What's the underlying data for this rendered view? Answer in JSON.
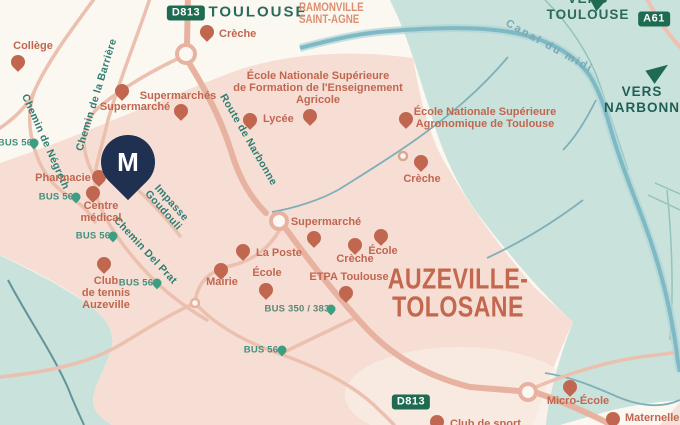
{
  "marker": {
    "letter": "M"
  },
  "badges": {
    "d813_top": "D813",
    "a61": "A61",
    "d813_bottom": "D813"
  },
  "cities": {
    "toulouse": "TOULOUSE",
    "ramonville": {
      "l1": "RAMONVILLE",
      "l2": "SAINT-AGNE"
    },
    "auzeville": {
      "l1": "AUZEVILLE-",
      "l2": "TOLOSANE"
    }
  },
  "directions": {
    "vers_toulouse": {
      "l1": "VERS",
      "l2": "TOULOUSE"
    },
    "vers_narbonne": {
      "l1": "VERS",
      "l2": "NARBONNE"
    }
  },
  "streets": {
    "barriere": "Chemin de la Barrière",
    "negreth": "Chemin de Négreth",
    "narbonne": "Route de Narbonne",
    "goudouli": {
      "l1": "Impasse",
      "l2": "Goudouli"
    },
    "delprat": "Chemin Del Prat",
    "canal": "Canal du midi"
  },
  "pois": [
    {
      "lines": [
        "Collège"
      ]
    },
    {
      "lines": [
        "Crèche"
      ]
    },
    {
      "lines": [
        "Supermarchés"
      ]
    },
    {
      "lines": [
        "Supermarché"
      ]
    },
    {
      "lines": [
        "Pharmacie"
      ]
    },
    {
      "lines": [
        "Centre",
        "médical"
      ]
    },
    {
      "lines": [
        "Club",
        "de tennis",
        "Auzeville"
      ]
    },
    {
      "lines": [
        "École Nationale Supérieure",
        "de Formation de l'Enseignement",
        "Agricole"
      ]
    },
    {
      "lines": [
        "Lycée"
      ]
    },
    {
      "lines": [
        "École Nationale Supérieure",
        "Agronomique de Toulouse"
      ]
    },
    {
      "lines": [
        "Crèche"
      ]
    },
    {
      "lines": [
        "Supermarché"
      ]
    },
    {
      "lines": [
        "La Poste"
      ]
    },
    {
      "lines": [
        "Mairie"
      ]
    },
    {
      "lines": [
        "École"
      ]
    },
    {
      "lines": [
        "Crèche"
      ]
    },
    {
      "lines": [
        "École"
      ]
    },
    {
      "lines": [
        "ETPA Toulouse"
      ]
    },
    {
      "lines": [
        "Micro-École"
      ]
    },
    {
      "lines": [
        "Maternelle"
      ]
    },
    {
      "lines": [
        "Club de sport"
      ]
    }
  ],
  "bus_stops": [
    {
      "label": "BUS 56"
    },
    {
      "label": "BUS 56"
    },
    {
      "label": "BUS 56"
    },
    {
      "label": "BUS 56"
    },
    {
      "label": "BUS 56"
    },
    {
      "label": "BUS 350 / 383"
    }
  ],
  "colors": {
    "background_cream": "#FBF7F1",
    "urban_pink": "#F6DED4",
    "field_teal": "#C9E2DB",
    "road_salmon": "#E7B2A0",
    "canal_blue": "#7FB9C4",
    "poi_terracotta": "#C1664F",
    "street_teal": "#2F7D72",
    "bus_green": "#3D9E82",
    "badge_green": "#1E6B52",
    "city_dark_teal": "#2A6A5B",
    "ramonville_salmon": "#DD8F70",
    "marker_navy": "#1F3050"
  }
}
